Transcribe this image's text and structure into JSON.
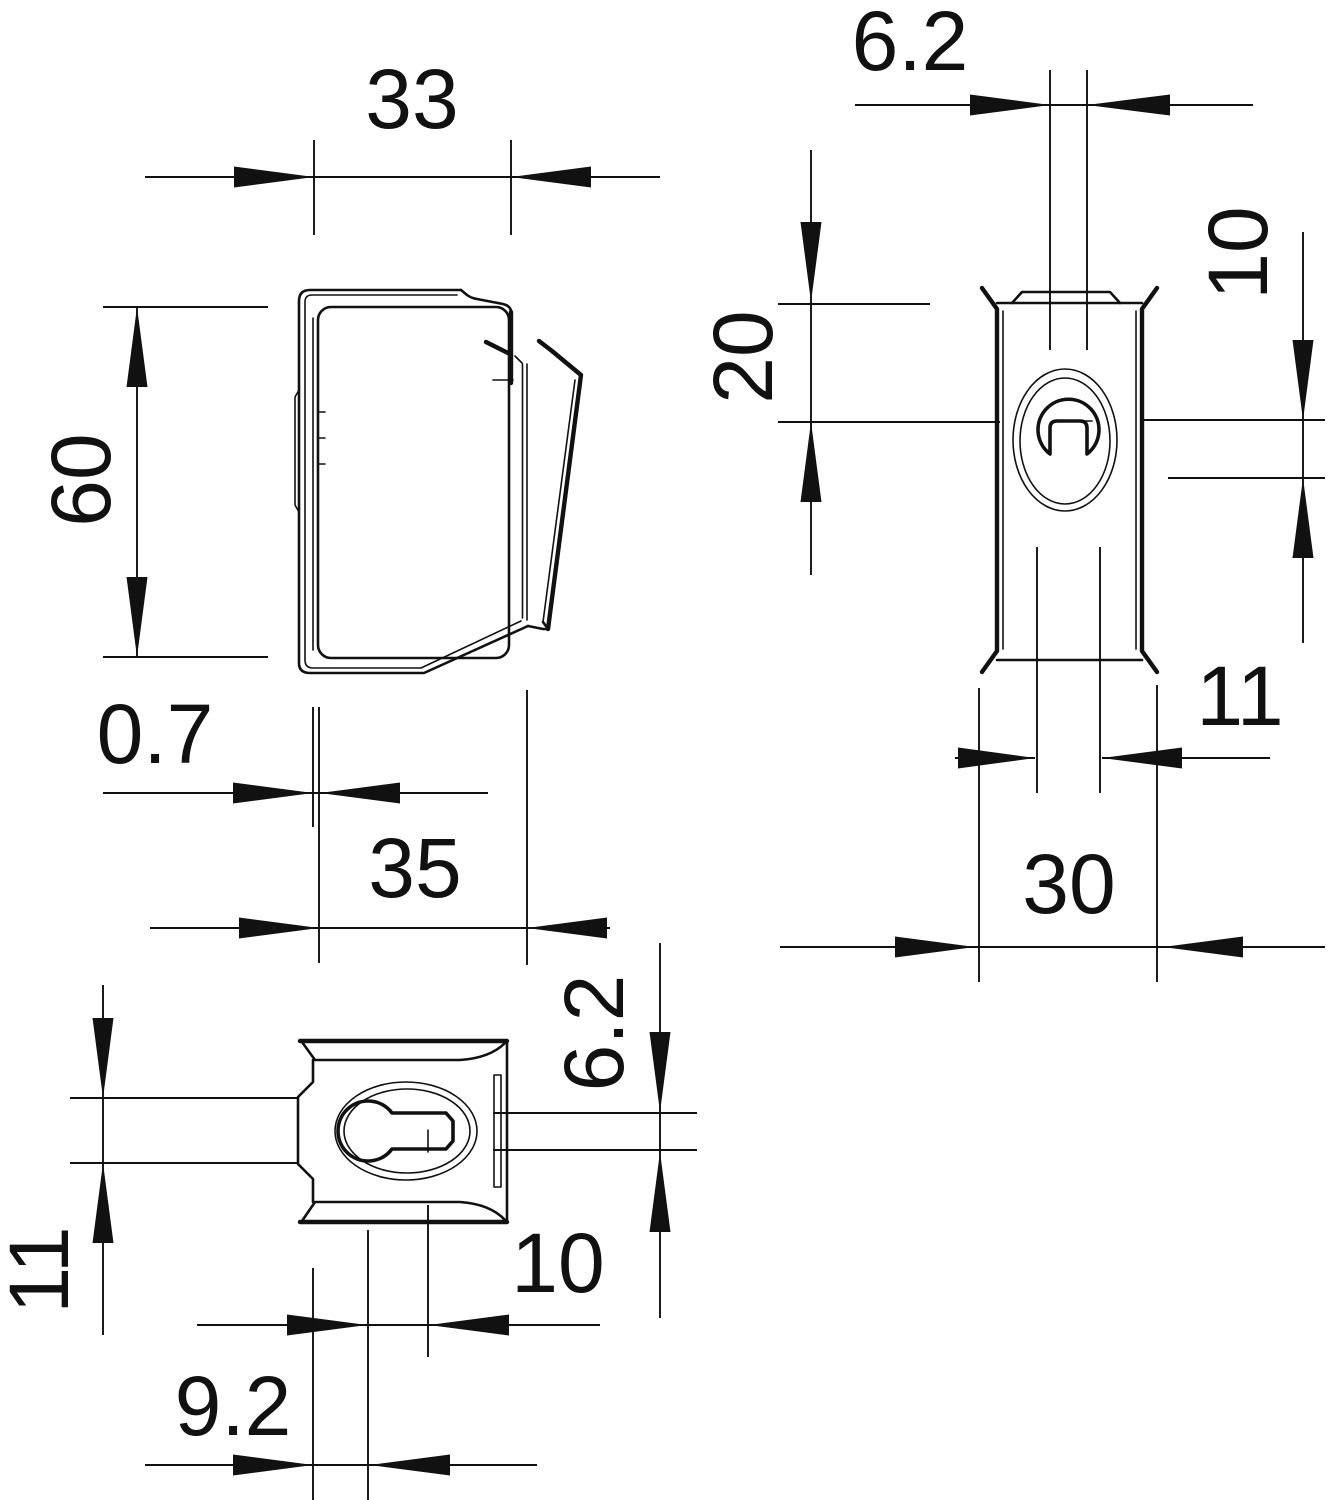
{
  "drawing": {
    "type": "technical-dimension-drawing",
    "background_color": "#ffffff",
    "line_color": "#111111",
    "views": {
      "side": {
        "label": "side-view",
        "dims": {
          "width": "33",
          "height": "60",
          "sheet_thickness": "0.7",
          "depth": "35"
        }
      },
      "front": {
        "label": "front-view",
        "dims": {
          "slot_width": "6.2",
          "top_to_slot_end": "20",
          "slot_end_to_hole_center": "10",
          "hole_diameter": "11",
          "overall_width": "30"
        }
      },
      "top": {
        "label": "top-view",
        "dims": {
          "tab_width": "11",
          "slot_width": "6.2",
          "hole_center_to_slot_end": "10",
          "edge_to_hole_center": "9.2"
        }
      }
    }
  }
}
